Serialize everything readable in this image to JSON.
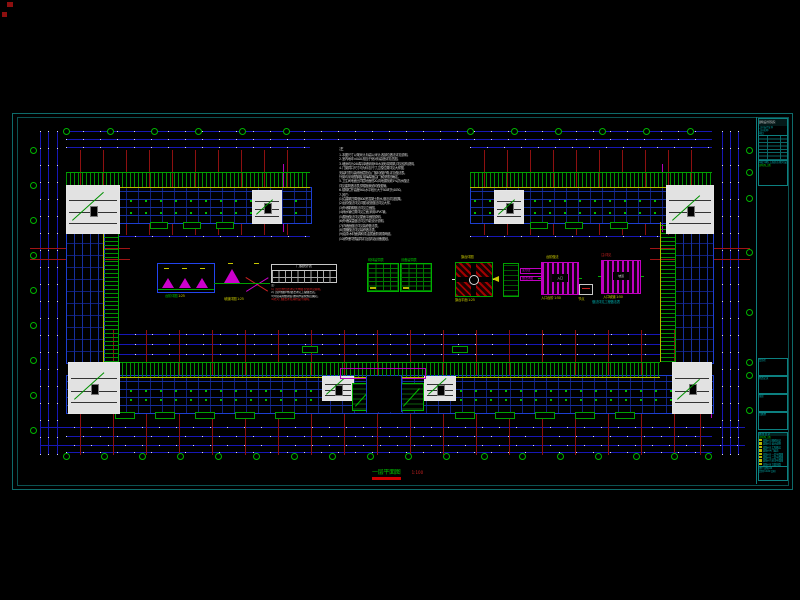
{
  "drawing": {
    "notes": {
      "title": "注",
      "lines": [
        "1. 本图尺寸以毫米计,标高以米计,各部位做法详见说明。",
        "2. 室内地坪±0.00,相当于绝对标高值详见总图。",
        "3. 墙身均为240厚,砖墙采用M5水泥砂浆砌筑,详见结构说明。",
        "4. 门窗洞口尺寸均为标志尺寸,立樘位置详见大样图,",
        "   安装时须与装修面层配合,门窗均做护角,详见做法表。",
        "   外窗均采用塑钢窗,玻璃厚度由厂家按规范确定。",
        "5. 卫生间地面比同层地面低20,向地漏找坡1%,防水做法",
        "   详见建筑做法表,穿楼板管道均做套管。",
        "6. 楼梯栏杆高度900,水平段长大于500时为1050。",
        "7. 其它:",
        "(1)沿建筑四周做800宽混凝土散水,做法详见图集。",
        "(2)台阶做法详见详图,坡道做法详见大样。",
        "(3)外墙勒脚做法详见立面图。",
        "(4)雨水管位置详见立面,采用UPVC管。",
        "(5)屋面做法详见屋面平面图说明。",
        "(6)外墙保温做法详见节能设计说明。",
        "(7)内墙面做法详见装修做法表。",
        "(8)顶棚做法详见装修做法表。",
        "(9)油漆:木材面调和漆,金属面防锈漆两道。",
        "(10)预埋件预留洞详见结构及设备图纸。"
      ]
    },
    "plan_title": {
      "text": "一层平面图",
      "scale": "1:100"
    },
    "details": {
      "d1": {
        "caption": "台阶详图",
        "scale": "1:25"
      },
      "d2": {
        "caption": "坡道详图",
        "scale": "1:25"
      },
      "d3": {
        "title": "门窗统计表",
        "notes": [
          {
            "t": "注:",
            "c": "wht"
          },
          {
            "t": "1.门窗立樘位置详见大样图,安装详见说明。",
            "c": "red"
          },
          {
            "t": "2.门窗均做护角,做法详见工程做法表。",
            "c": "wht"
          },
          {
            "t": "3.外窗采用塑钢窗,玻璃厚度按规范确定。",
            "c": "wht"
          },
          {
            "t": "4.防火门做法详见消防设计说明。",
            "c": "red"
          }
        ]
      },
      "d4": {
        "t1": "砌体留洞表",
        "t2": "设备留洞表"
      },
      "d5": {
        "cap_top": "旗台详图",
        "cap_bottom": "旗台平面 1:25"
      },
      "d6": {
        "label1": "变形缝",
        "label2": "做法详图"
      },
      "d7": {
        "cap_top": "台阶做法",
        "center": "入口",
        "cap_bottom": "入口台阶 1:50"
      },
      "d8": {
        "cap_red": "注:详见",
        "center": "坡道",
        "cap_bottom": "入口坡道 1:50",
        "cap_cyan": "做法详见工程做法表"
      },
      "d9": {
        "cap": "节点"
      }
    },
    "title_block": {
      "org": "建筑设计研究院",
      "cert": "工程设计证书",
      "proj": "工程名称",
      "item": "项目",
      "roles": "审定 审核 工程负责 校对 设计 制图",
      "stage": "建筑施工图",
      "cells": [
        "会签栏",
        "修改记录",
        "备注",
        "出图章"
      ],
      "list_title": "图 纸 目 录",
      "list_sub": "建筑施工图",
      "rows": [
        "建施-01 图纸目录",
        "建施-02 设计说明",
        "建施-03 工程做法",
        "建施-04 门窗表",
        "建施-05 一层平面图",
        "建施-06 二层平面图",
        "建施-07 屋顶平面图",
        "建施-08 立面剖面"
      ],
      "footer1": "图号 建施-04",
      "footer2": "比例 1:100  日期"
    },
    "geometry": {
      "artifacts": [
        [
          7,
          2,
          6,
          5
        ],
        [
          2,
          12,
          5,
          5
        ]
      ],
      "dim_h": [
        [
          66,
          131,
          646
        ],
        [
          66,
          139,
          646
        ],
        [
          66,
          147,
          244
        ],
        [
          470,
          147,
          242
        ],
        [
          118,
          236,
          192
        ],
        [
          470,
          236,
          190
        ],
        [
          118,
          334,
          542
        ],
        [
          118,
          344,
          542
        ],
        [
          118,
          354,
          542
        ],
        [
          40,
          427,
          705
        ],
        [
          66,
          436,
          646
        ],
        [
          40,
          445,
          705
        ],
        [
          66,
          452,
          646
        ]
      ],
      "dim_v": [
        [
          40,
          131,
          324
        ],
        [
          48,
          131,
          324
        ],
        [
          57,
          131,
          324
        ],
        [
          722,
          131,
          324
        ],
        [
          730,
          131,
          324
        ],
        [
          738,
          131,
          324
        ]
      ],
      "red_v": [
        [
          80,
          150,
          85
        ],
        [
          103,
          150,
          85
        ],
        [
          126,
          150,
          85
        ],
        [
          149,
          150,
          85
        ],
        [
          172,
          150,
          85
        ],
        [
          195,
          150,
          85
        ],
        [
          218,
          150,
          85
        ],
        [
          241,
          150,
          85
        ],
        [
          264,
          150,
          85
        ],
        [
          287,
          150,
          85
        ],
        [
          484,
          150,
          85
        ],
        [
          507,
          150,
          85
        ],
        [
          530,
          150,
          85
        ],
        [
          553,
          150,
          85
        ],
        [
          576,
          150,
          85
        ],
        [
          599,
          150,
          85
        ],
        [
          622,
          150,
          85
        ],
        [
          645,
          150,
          85
        ],
        [
          668,
          150,
          85
        ],
        [
          691,
          150,
          85
        ],
        [
          80,
          330,
          125
        ],
        [
          113,
          330,
          125
        ],
        [
          146,
          330,
          125
        ],
        [
          179,
          330,
          125
        ],
        [
          212,
          330,
          125
        ],
        [
          245,
          330,
          125
        ],
        [
          278,
          330,
          125
        ],
        [
          311,
          330,
          125
        ],
        [
          344,
          330,
          125
        ],
        [
          377,
          330,
          125
        ],
        [
          410,
          330,
          125
        ],
        [
          443,
          330,
          125
        ],
        [
          476,
          330,
          125
        ],
        [
          509,
          330,
          125
        ],
        [
          542,
          330,
          125
        ],
        [
          575,
          330,
          125
        ],
        [
          608,
          330,
          125
        ],
        [
          641,
          330,
          125
        ],
        [
          674,
          330,
          125
        ],
        [
          700,
          330,
          125
        ]
      ],
      "red_h": [
        [
          30,
          248,
          100
        ],
        [
          30,
          259,
          100
        ],
        [
          650,
          248,
          100
        ],
        [
          650,
          259,
          100
        ],
        [
          66,
          408,
          646
        ]
      ],
      "mag_v": [
        [
          283,
          164,
          68
        ],
        [
          662,
          164,
          68
        ],
        [
          711,
          356,
          62
        ]
      ],
      "bub_top": {
        "y": 128,
        "x": [
          66,
          110,
          154,
          198,
          242,
          286,
          470,
          514,
          558,
          602,
          646,
          690
        ]
      },
      "bub_bottom": {
        "y": 453,
        "x": [
          66,
          104,
          142,
          180,
          218,
          256,
          294,
          332,
          370,
          408,
          446,
          484,
          522,
          560,
          598,
          636,
          674,
          708
        ]
      },
      "bub_left": {
        "x": 30,
        "y": [
          150,
          185,
          220,
          255,
          290,
          325,
          360,
          395,
          430
        ]
      },
      "bub_right": {
        "x": 746,
        "y": [
          150,
          172,
          198,
          252,
          312,
          362,
          375,
          410
        ]
      },
      "hatch_h": [
        [
          66,
          172,
          244
        ],
        [
          470,
          172,
          242
        ],
        [
          118,
          362,
          542
        ]
      ],
      "hatch_v": [
        [
          103,
          222,
          140
        ],
        [
          660,
          222,
          140
        ]
      ],
      "band_h": [
        [
          66,
          187,
          244,
          35
        ],
        [
          470,
          187,
          242,
          35
        ],
        [
          66,
          375,
          646,
          37
        ]
      ],
      "band_v": [
        [
          66,
          222,
          37,
          140
        ],
        [
          675,
          222,
          37,
          140
        ]
      ],
      "specks": [
        [
          70,
          200,
          236
        ],
        [
          474,
          200,
          234
        ],
        [
          70,
          212,
          236
        ],
        [
          474,
          212,
          234
        ],
        [
          70,
          390,
          640
        ],
        [
          70,
          399,
          640
        ]
      ],
      "stairs": [
        [
          66,
          185,
          52,
          47
        ],
        [
          666,
          185,
          46,
          47
        ],
        [
          68,
          362,
          50,
          50
        ],
        [
          672,
          362,
          38,
          50
        ],
        [
          252,
          190,
          28,
          32
        ],
        [
          494,
          190,
          28,
          32
        ],
        [
          322,
          376,
          30,
          23
        ],
        [
          424,
          376,
          30,
          23
        ]
      ],
      "gboxes": [
        [
          352,
          383,
          22,
          26
        ],
        [
          400,
          383,
          22,
          26
        ]
      ],
      "bumps": [
        [
          150,
          222,
          18
        ],
        [
          183,
          222,
          18
        ],
        [
          216,
          222,
          18
        ],
        [
          530,
          222,
          18
        ],
        [
          565,
          222,
          18
        ],
        [
          610,
          222,
          18
        ],
        [
          302,
          346,
          16
        ],
        [
          452,
          346,
          16
        ],
        [
          115,
          412,
          20
        ],
        [
          155,
          412,
          20
        ],
        [
          195,
          412,
          20
        ],
        [
          235,
          412,
          20
        ],
        [
          275,
          412,
          20
        ],
        [
          455,
          412,
          20
        ],
        [
          495,
          412,
          20
        ],
        [
          535,
          412,
          20
        ],
        [
          575,
          412,
          20
        ],
        [
          615,
          412,
          20
        ]
      ]
    },
    "colors": {
      "background": "#000000",
      "frame": "#0e6a6a",
      "dim_blue": "#1717b4",
      "grid_red": "#8d1010",
      "axis_green": "#00b400",
      "hatch_green": "#009000",
      "wall_blue": "#1d3fd0",
      "magenta": "#c000c0",
      "caption_yellow": "#c8c800",
      "text_cyan": "#00a8a8"
    }
  }
}
